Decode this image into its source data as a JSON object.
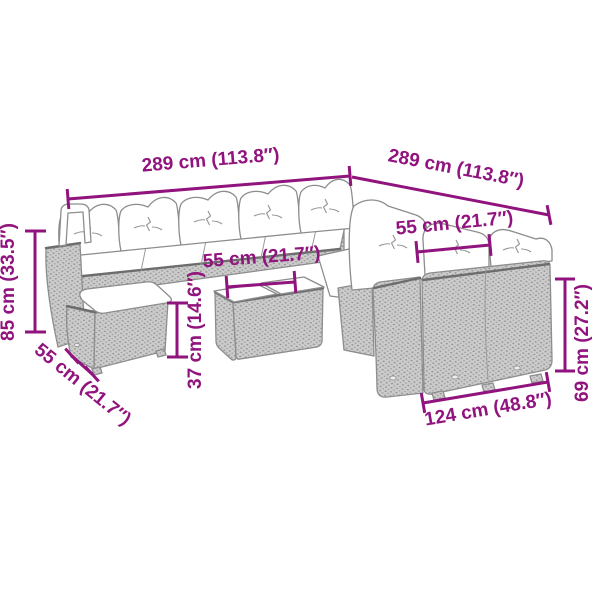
{
  "page": {
    "background_color": "#ffffff"
  },
  "colors": {
    "dimension_accent": "#91137e",
    "drawing_outline": "#8d8d8d",
    "drawing_edge_shadow": "#6d6d6d",
    "rattan_fill": "#cccccc",
    "rattan_weave_dot": "#909090",
    "cushion_fill": "#ffffff"
  },
  "diagram": {
    "dimensions": {
      "back_width": {
        "label": "289 cm (113.8″)",
        "cm": "289",
        "inches": "113.8"
      },
      "side_width": {
        "label": "289 cm (113.8″)",
        "cm": "289",
        "inches": "113.8"
      },
      "right_seat_width": {
        "label": "55 cm (21.7″)",
        "cm": "55",
        "inches": "21.7"
      },
      "table_width": {
        "label": "55 cm (21.7″)",
        "cm": "55",
        "inches": "21.7"
      },
      "back_height": {
        "label": "85 cm (33.5″)",
        "cm": "85",
        "inches": "33.5"
      },
      "seat_height": {
        "label": "37 cm (14.6″)",
        "cm": "37",
        "inches": "14.6"
      },
      "footstool_depth": {
        "label": "55 cm (21.7″)",
        "cm": "55",
        "inches": "21.7"
      },
      "sofa_height": {
        "label": "69 cm (27.2″)",
        "cm": "69",
        "inches": "27.2"
      },
      "front_sofa_width": {
        "label": "124 cm (48.8″)",
        "cm": "124",
        "inches": "48.8"
      }
    }
  }
}
